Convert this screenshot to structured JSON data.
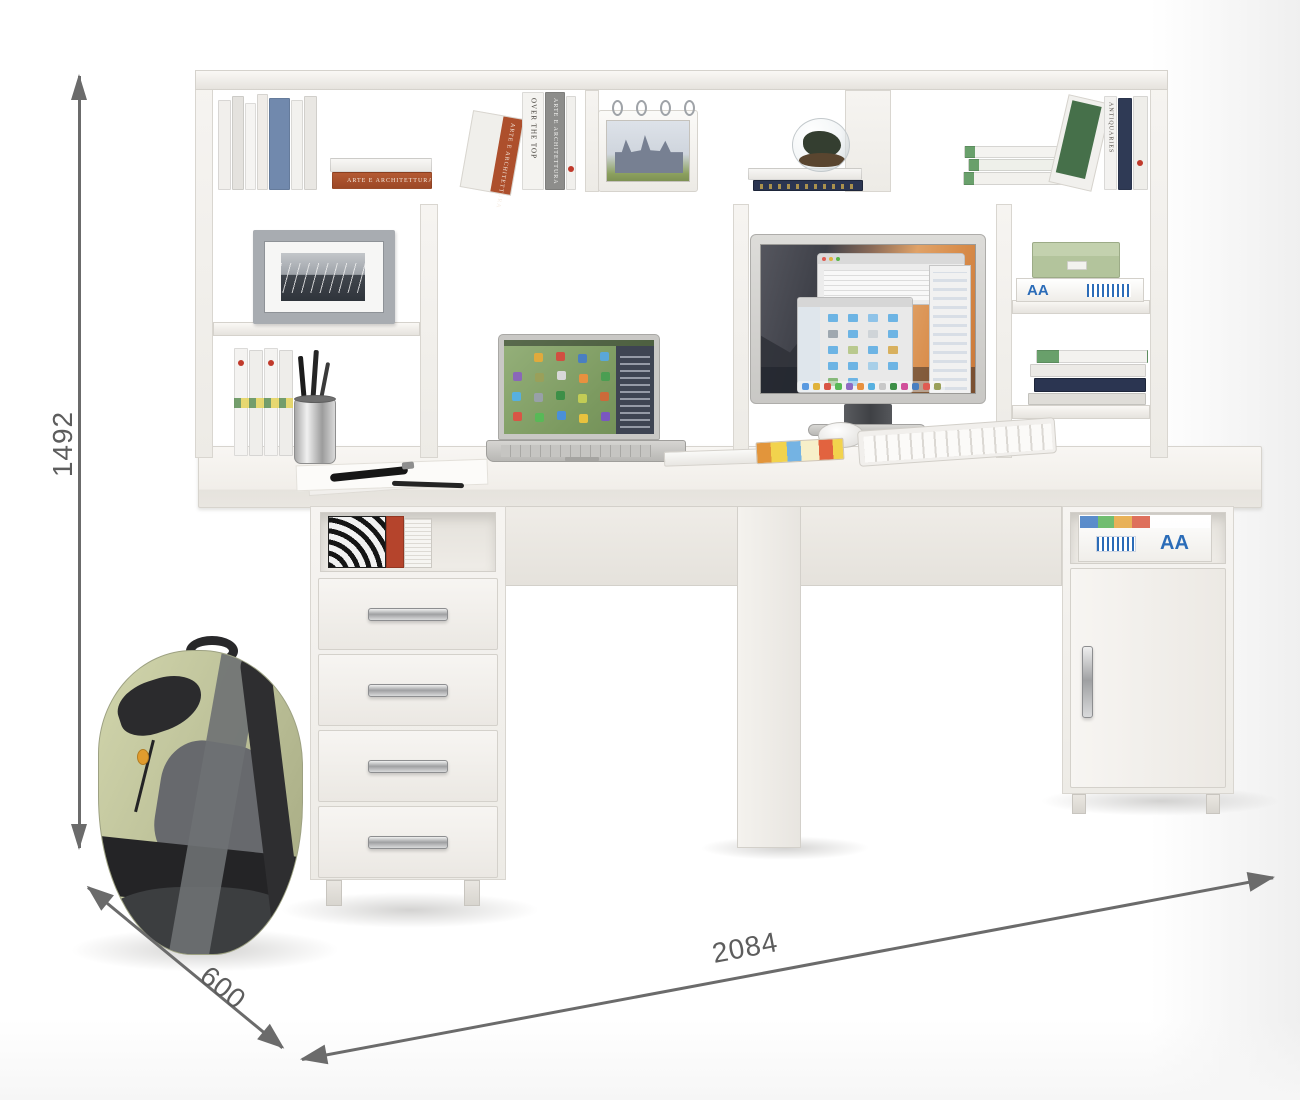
{
  "annotations": {
    "height": "1492",
    "depth": "600",
    "width": "2084"
  },
  "labels": {
    "paper_box": "AA",
    "over_top_title": "OVER THE TOP",
    "arte_title": "ARTE E ARCHITETTURA",
    "antiquaries_title": "ANTIQUARIES"
  },
  "colors": {
    "furniture_white": "#f3f1ee",
    "dimension_gray": "#6b6b6b",
    "backpack_olive": "#bcc098",
    "backpack_dark": "#2a2a2c",
    "box_green": "#b9c9a4",
    "book_navy": "#2b3551",
    "book_blue": "#7189ad",
    "book_red": "#ad4f2c",
    "laptop_screen_green": "#82a065",
    "monitor_sunset_orange": "#d88c4a"
  }
}
